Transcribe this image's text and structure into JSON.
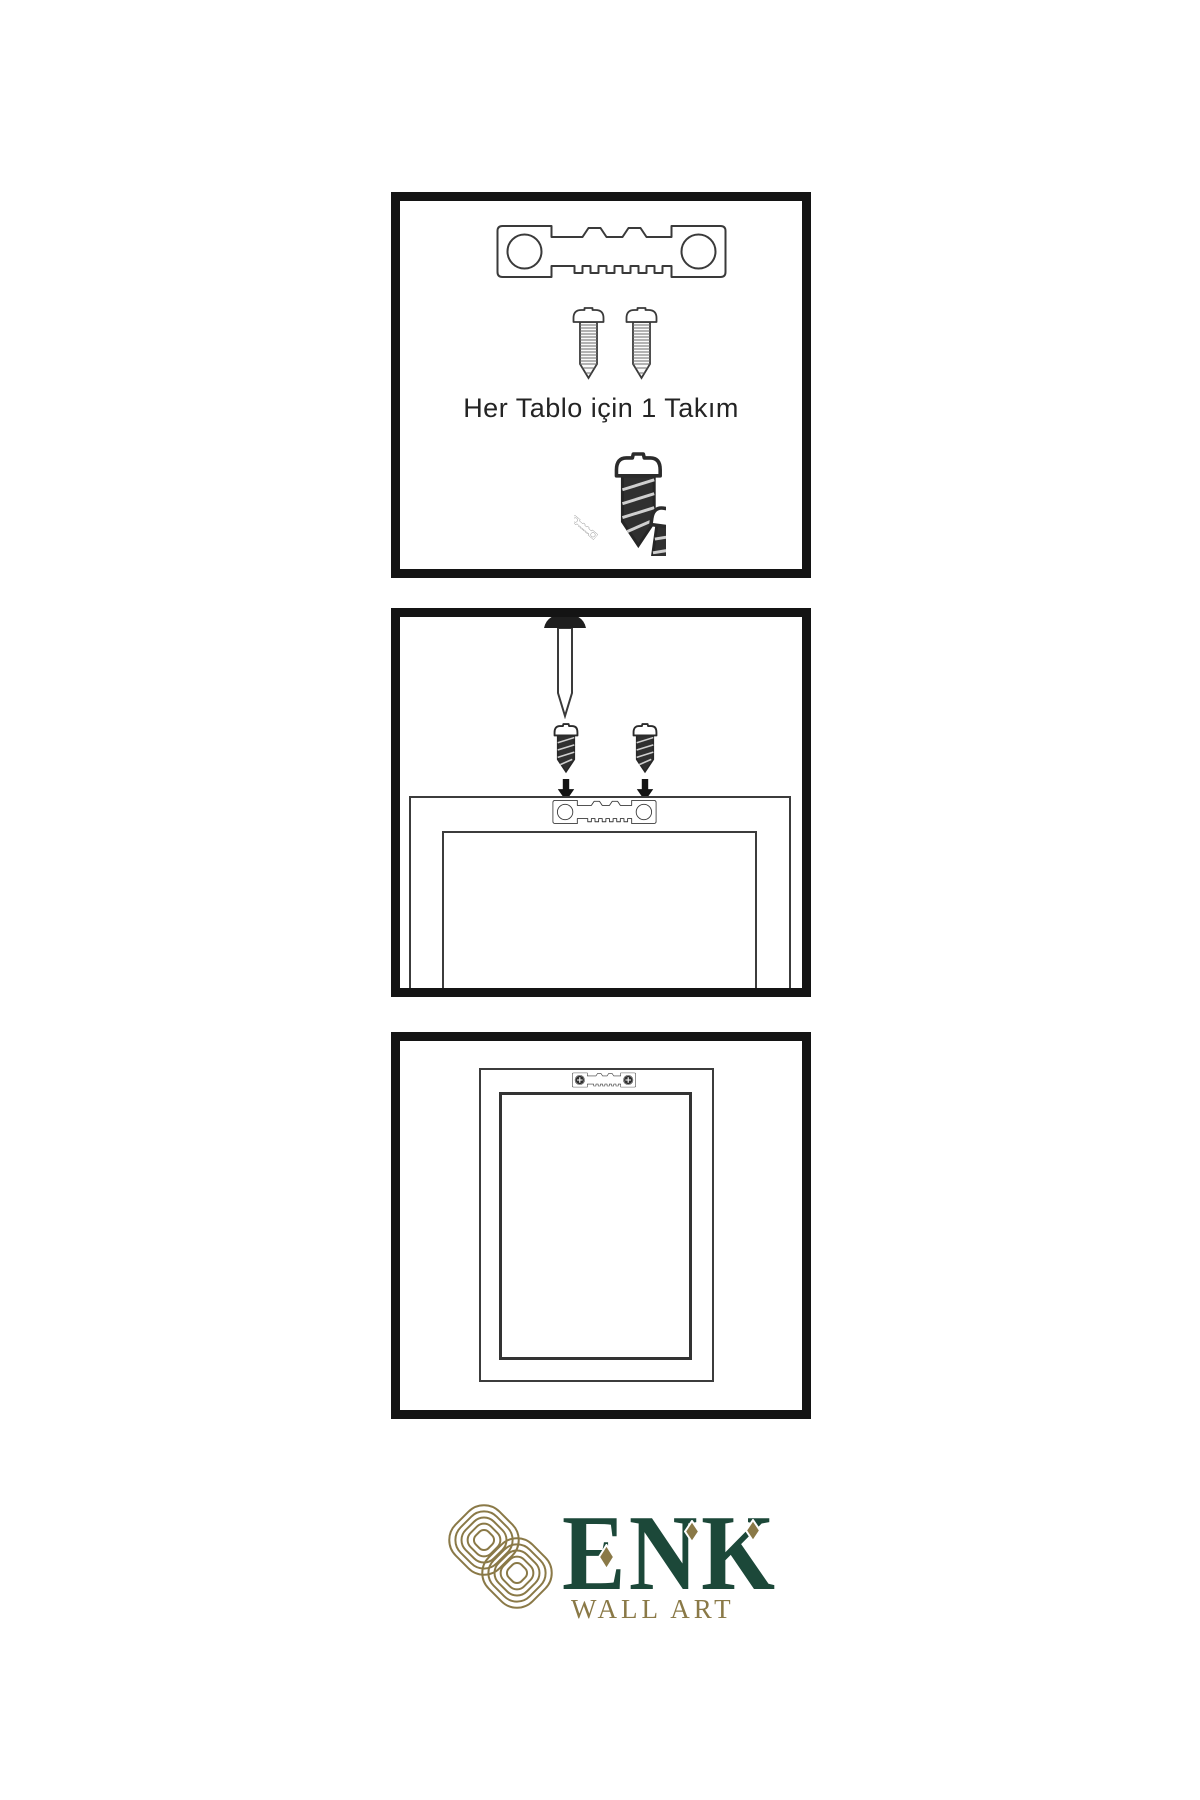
{
  "panels": {
    "kit": {
      "caption": "Her Tablo için 1 Takım",
      "icons": [
        "sawtooth-hanger-icon",
        "screw-icon",
        "screw-icon",
        "screw-into-hanger-icon"
      ]
    },
    "mounting": {
      "icons": [
        "nail-icon",
        "screw-icon",
        "arrow-down-icon",
        "picture-frame-outline",
        "sawtooth-hanger-icon"
      ]
    },
    "hung": {
      "icons": [
        "picture-frame-outline",
        "installed-hanger-icon"
      ]
    }
  },
  "logo": {
    "brand": "ENK",
    "subtitle": "WALL ART"
  },
  "colors": {
    "background": "#ffffff",
    "panel_border": "#141414",
    "line": "#3a3a3a",
    "dark_hardware": "#2e2e2e",
    "logo_gold": "#8a7947",
    "logo_green": "#1c4839"
  }
}
